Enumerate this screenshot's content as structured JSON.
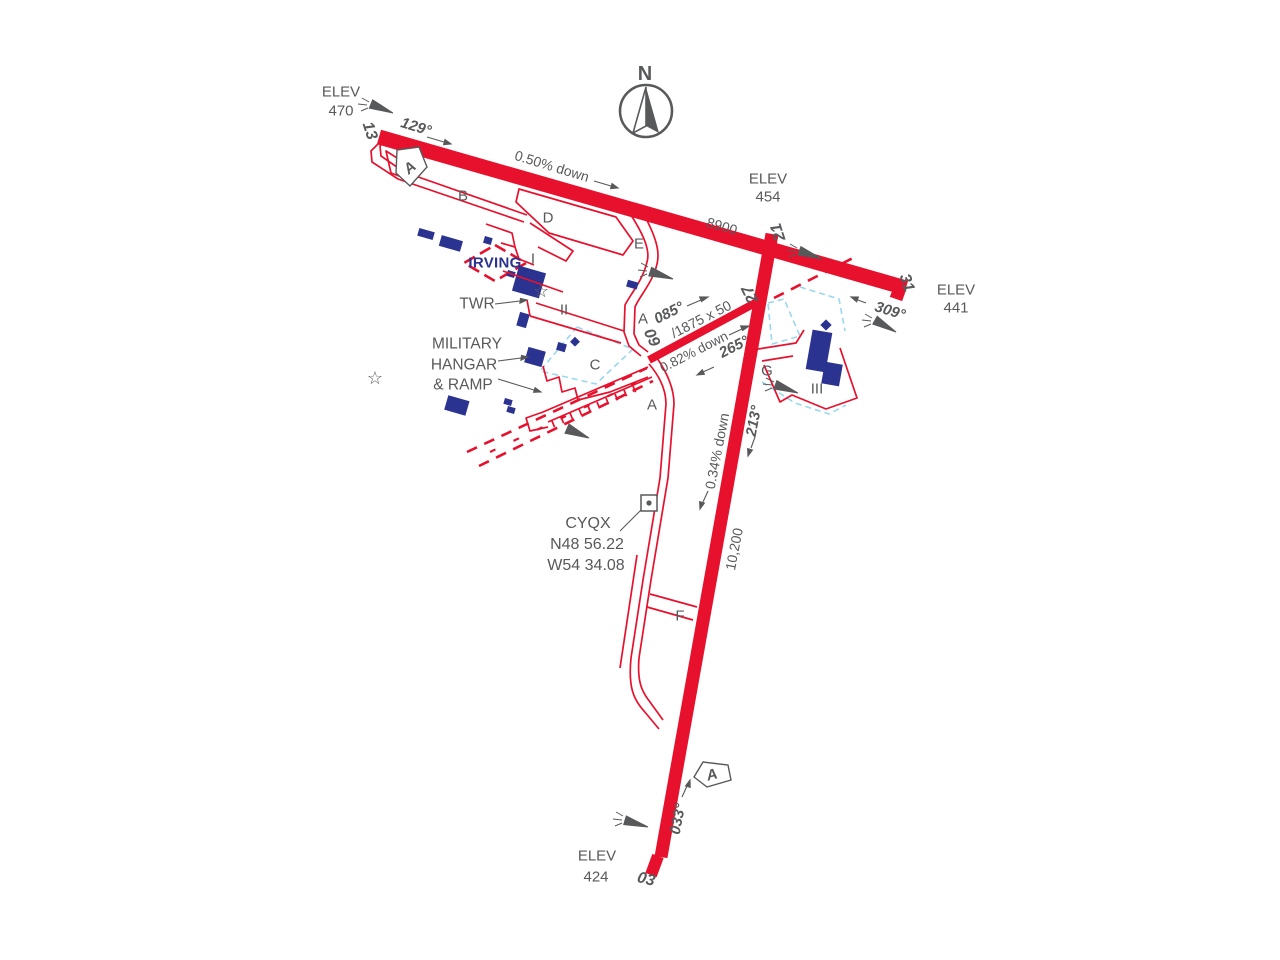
{
  "colors": {
    "runway_red": "#E8112D",
    "building_blue": "#2B3390",
    "label_gray": "#58595B",
    "apron_outline_cyan": "#9BD7EE",
    "irving_blue": "#2B3390"
  },
  "site": {
    "north": "N",
    "elev_label": "ELEV",
    "irving": "IRVING",
    "twr": "TWR",
    "military": [
      "MILITARY",
      "HANGAR",
      "& RAMP"
    ],
    "code": "CYQX",
    "lat": "N48 56.22",
    "lon": "W54 34.08",
    "approach_a": "A"
  },
  "elevations": {
    "e470": "470",
    "e454": "454",
    "e441": "441",
    "e424": "424"
  },
  "runways": [
    {
      "id": "13/31",
      "thr_a": "13",
      "thr_b": "31",
      "hdg_a": "129°",
      "hdg_b": "309°",
      "slope": "0.50% down",
      "length": "8900"
    },
    {
      "id": "03/21",
      "thr_a": "03",
      "thr_b": "21",
      "hdg_a": "033°",
      "hdg_b": "213°",
      "slope": "0.34% down",
      "length": "10,200"
    },
    {
      "id": "09/27",
      "thr_a": "09",
      "thr_b": "27",
      "hdg_a": "085°",
      "hdg_b": "265°",
      "slope": "0.82% down",
      "size": "/1875 x 50"
    }
  ],
  "taxiways": {
    "A": "A",
    "B": "B",
    "C": "C",
    "D": "D",
    "E": "E",
    "F": "F",
    "G": "G"
  },
  "aprons": {
    "I": "I",
    "II": "II",
    "III": "III"
  },
  "icons": {
    "star": "☆"
  }
}
